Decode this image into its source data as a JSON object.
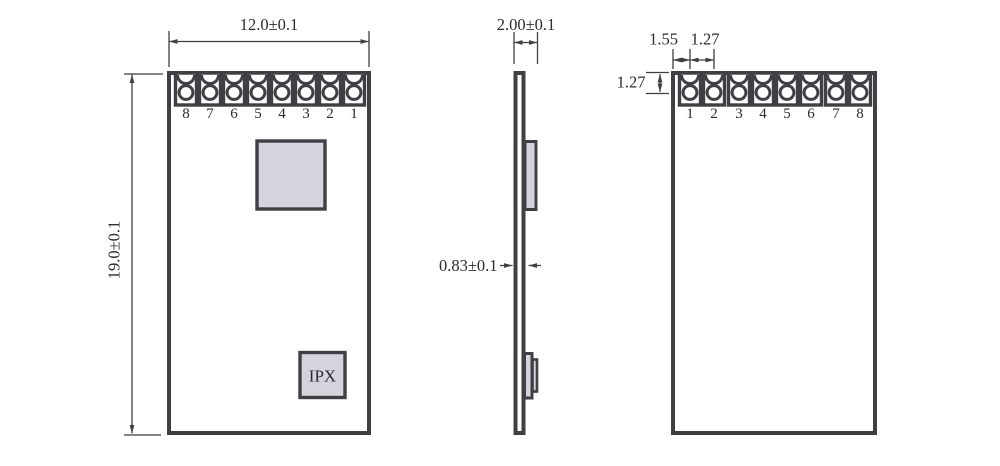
{
  "palette": {
    "bg": "#ffffff",
    "stroke": "#3f3f44",
    "component-fill": "#d5d4dc",
    "text": "#2b2b30"
  },
  "front_view": {
    "width_dim": "12.0±0.1",
    "height_dim": "19.0±0.1",
    "pins": [
      "8",
      "7",
      "6",
      "5",
      "4",
      "3",
      "2",
      "1"
    ],
    "ipx_label": "IPX"
  },
  "side_view": {
    "overall_thickness_dim": "2.00±0.1",
    "pcb_thickness_dim": "0.83±0.1"
  },
  "back_view": {
    "edge_to_pin1_dim": "1.55",
    "pin_pitch_dim": "1.27",
    "top_to_hole_center_dim": "1.27",
    "pins": [
      "1",
      "2",
      "3",
      "4",
      "5",
      "6",
      "7",
      "8"
    ]
  }
}
